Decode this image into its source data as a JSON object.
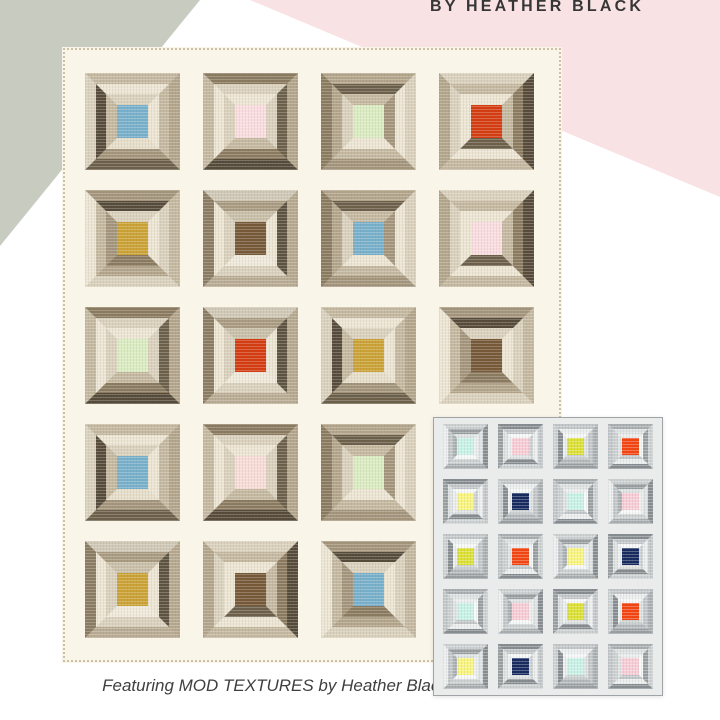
{
  "page": {
    "background": "#ffffff"
  },
  "header": {
    "byline": "BY HEATHER BLACK",
    "text_color": "#363636"
  },
  "background_shapes": {
    "gray_triangle_color": "#c7cbc0",
    "pink_wedge_color": "#f8e2e4"
  },
  "caption": {
    "text": "Featuring MOD TEXTURES by Heather Black",
    "color": "#3f3f3f"
  },
  "main_quilt": {
    "rows": 5,
    "columns": 4,
    "background": "#faf5e9",
    "stitch_color": "#ccc0a6",
    "center_colors": {
      "blue": "#77b0cc",
      "pink": "#fadde0",
      "green": "#daecc1",
      "red": "#d53b10",
      "mustard": "#cba235",
      "brown": "#755838",
      "blush": "#f8dcd8"
    },
    "blocks": [
      {
        "row": 1,
        "col": 1,
        "center": "blue",
        "style": 0
      },
      {
        "row": 1,
        "col": 2,
        "center": "pink",
        "style": 1
      },
      {
        "row": 1,
        "col": 3,
        "center": "green",
        "style": 2
      },
      {
        "row": 1,
        "col": 4,
        "center": "red",
        "style": 3
      },
      {
        "row": 2,
        "col": 1,
        "center": "mustard",
        "style": 4
      },
      {
        "row": 2,
        "col": 2,
        "center": "brown",
        "style": 5
      },
      {
        "row": 2,
        "col": 3,
        "center": "blue",
        "style": 2
      },
      {
        "row": 2,
        "col": 4,
        "center": "pink",
        "style": 3
      },
      {
        "row": 3,
        "col": 1,
        "center": "green",
        "style": 1
      },
      {
        "row": 3,
        "col": 2,
        "center": "red",
        "style": 5
      },
      {
        "row": 3,
        "col": 3,
        "center": "mustard",
        "style": 0
      },
      {
        "row": 3,
        "col": 4,
        "center": "brown",
        "style": 4
      },
      {
        "row": 4,
        "col": 1,
        "center": "blue",
        "style": 0
      },
      {
        "row": 4,
        "col": 2,
        "center": "blush",
        "style": 1
      },
      {
        "row": 4,
        "col": 3,
        "center": "green",
        "style": 2
      },
      {
        "row": 5,
        "col": 1,
        "center": "mustard",
        "style": 5
      },
      {
        "row": 5,
        "col": 2,
        "center": "brown",
        "style": 3
      },
      {
        "row": 5,
        "col": 3,
        "center": "blue",
        "style": 4
      }
    ],
    "ring_styles": [
      [
        {
          "t": "#c4b8a1",
          "r": "#b2a58c",
          "b": "#6b5f49",
          "l": "#d9d1bd"
        },
        {
          "t": "#ece5d4",
          "r": "#c4b8a1",
          "b": "#a3957c",
          "l": "#554a3a"
        },
        {
          "t": "#d9d1bd",
          "r": "#ece5d4",
          "b": "#e6decb",
          "l": "#c4b8a1"
        }
      ],
      [
        {
          "t": "#8a7a60",
          "r": "#b2a58c",
          "b": "#554a3a",
          "l": "#c4b8a1"
        },
        {
          "t": "#d9d1bd",
          "r": "#6b5f49",
          "b": "#8a7a60",
          "l": "#ece5d4"
        },
        {
          "t": "#ece5d4",
          "r": "#d9d1bd",
          "b": "#c4b8a1",
          "l": "#d9d1bd"
        }
      ],
      [
        {
          "t": "#b2a58c",
          "r": "#d9d1bd",
          "b": "#a3957c",
          "l": "#8a7a60"
        },
        {
          "t": "#6b5f49",
          "r": "#ece5d4",
          "b": "#c4b8a1",
          "l": "#b2a58c"
        },
        {
          "t": "#c4b8a1",
          "r": "#a3957c",
          "b": "#ece5d4",
          "l": "#d9d1bd"
        }
      ],
      [
        {
          "t": "#d9d1bd",
          "r": "#554a3a",
          "b": "#c4b8a1",
          "l": "#b2a58c"
        },
        {
          "t": "#c4b8a1",
          "r": "#8a7a60",
          "b": "#ece5d4",
          "l": "#d9d1bd"
        },
        {
          "t": "#ece5d4",
          "r": "#c4b8a1",
          "b": "#6b5f49",
          "l": "#ece5d4"
        }
      ],
      [
        {
          "t": "#a3957c",
          "r": "#c4b8a1",
          "b": "#d9d1bd",
          "l": "#ece5d4"
        },
        {
          "t": "#554a3a",
          "r": "#d9d1bd",
          "b": "#b2a58c",
          "l": "#c4b8a1"
        },
        {
          "t": "#d9d1bd",
          "r": "#ece5d4",
          "b": "#8a7a60",
          "l": "#a3957c"
        }
      ],
      [
        {
          "t": "#cfc8b6",
          "r": "#b5a88f",
          "b": "#b9ac94",
          "l": "#8a7b63"
        },
        {
          "t": "#a99b82",
          "r": "#5c5240",
          "b": "#d9d1bd",
          "l": "#ece5d4"
        },
        {
          "t": "#c9bfa8",
          "r": "#ece5d4",
          "b": "#efe9db",
          "l": "#d9d1bd"
        }
      ]
    ]
  },
  "inset_quilt": {
    "rows": 5,
    "columns": 4,
    "card_background": "#eaecec",
    "border_color": "#9fa5a7",
    "center_colors": {
      "aqua": "#c9f2e7",
      "pink": "#f8cdd5",
      "chartreuse": "#dde134",
      "orange": "#f4440f",
      "yellow": "#f9f57f",
      "navy": "#16295e"
    },
    "blocks": [
      {
        "row": 1,
        "col": 1,
        "center": "aqua",
        "style": 2
      },
      {
        "row": 1,
        "col": 2,
        "center": "pink",
        "style": 3
      },
      {
        "row": 1,
        "col": 3,
        "center": "chartreuse",
        "style": 0
      },
      {
        "row": 1,
        "col": 4,
        "center": "orange",
        "style": 1
      },
      {
        "row": 2,
        "col": 1,
        "center": "yellow",
        "style": 3
      },
      {
        "row": 2,
        "col": 2,
        "center": "navy",
        "style": 0
      },
      {
        "row": 2,
        "col": 3,
        "center": "aqua",
        "style": 1
      },
      {
        "row": 2,
        "col": 4,
        "center": "pink",
        "style": 2
      },
      {
        "row": 3,
        "col": 1,
        "center": "chartreuse",
        "style": 0
      },
      {
        "row": 3,
        "col": 2,
        "center": "orange",
        "style": 1
      },
      {
        "row": 3,
        "col": 3,
        "center": "yellow",
        "style": 2
      },
      {
        "row": 3,
        "col": 4,
        "center": "navy",
        "style": 3
      },
      {
        "row": 4,
        "col": 1,
        "center": "aqua",
        "style": 1
      },
      {
        "row": 4,
        "col": 2,
        "center": "pink",
        "style": 2
      },
      {
        "row": 4,
        "col": 3,
        "center": "chartreuse",
        "style": 3
      },
      {
        "row": 4,
        "col": 4,
        "center": "orange",
        "style": 0
      },
      {
        "row": 5,
        "col": 1,
        "center": "yellow",
        "style": 2
      },
      {
        "row": 5,
        "col": 2,
        "center": "navy",
        "style": 3
      },
      {
        "row": 5,
        "col": 3,
        "center": "aqua",
        "style": 0
      },
      {
        "row": 5,
        "col": 4,
        "center": "pink",
        "style": 1
      }
    ],
    "ring_styles": [
      [
        {
          "t": "#c3c7c9",
          "r": "#aab0b2",
          "b": "#9aa0a2",
          "l": "#cdd1d2"
        },
        {
          "t": "#eceeee",
          "r": "#c3c7c9",
          "b": "#b4babc",
          "l": "#878d90"
        },
        {
          "t": "#f7f8f8",
          "r": "#dfe2e2",
          "b": "#cdd1d2",
          "l": "#eceeee"
        }
      ],
      [
        {
          "t": "#aab0b2",
          "r": "#cdd1d2",
          "b": "#878d90",
          "l": "#c3c7c9"
        },
        {
          "t": "#dfe2e2",
          "r": "#9aa0a2",
          "b": "#eceeee",
          "l": "#cdd1d2"
        },
        {
          "t": "#eceeee",
          "r": "#f7f8f8",
          "b": "#c3c7c9",
          "l": "#dfe2e2"
        }
      ],
      [
        {
          "t": "#cdd1d2",
          "r": "#878d90",
          "b": "#aab0b2",
          "l": "#eceeee"
        },
        {
          "t": "#9aa0a2",
          "r": "#dfe2e2",
          "b": "#cdd1d2",
          "l": "#c3c7c9"
        },
        {
          "t": "#dfe2e2",
          "r": "#eceeee",
          "b": "#f7f8f8",
          "l": "#aab0b2"
        }
      ],
      [
        {
          "t": "#878d90",
          "r": "#c3c7c9",
          "b": "#cdd1d2",
          "l": "#9aa0a2"
        },
        {
          "t": "#c3c7c9",
          "r": "#eceeee",
          "b": "#878d90",
          "l": "#dfe2e2"
        },
        {
          "t": "#f7f8f8",
          "r": "#cdd1d2",
          "b": "#dfe2e2",
          "l": "#eceeee"
        }
      ]
    ]
  }
}
